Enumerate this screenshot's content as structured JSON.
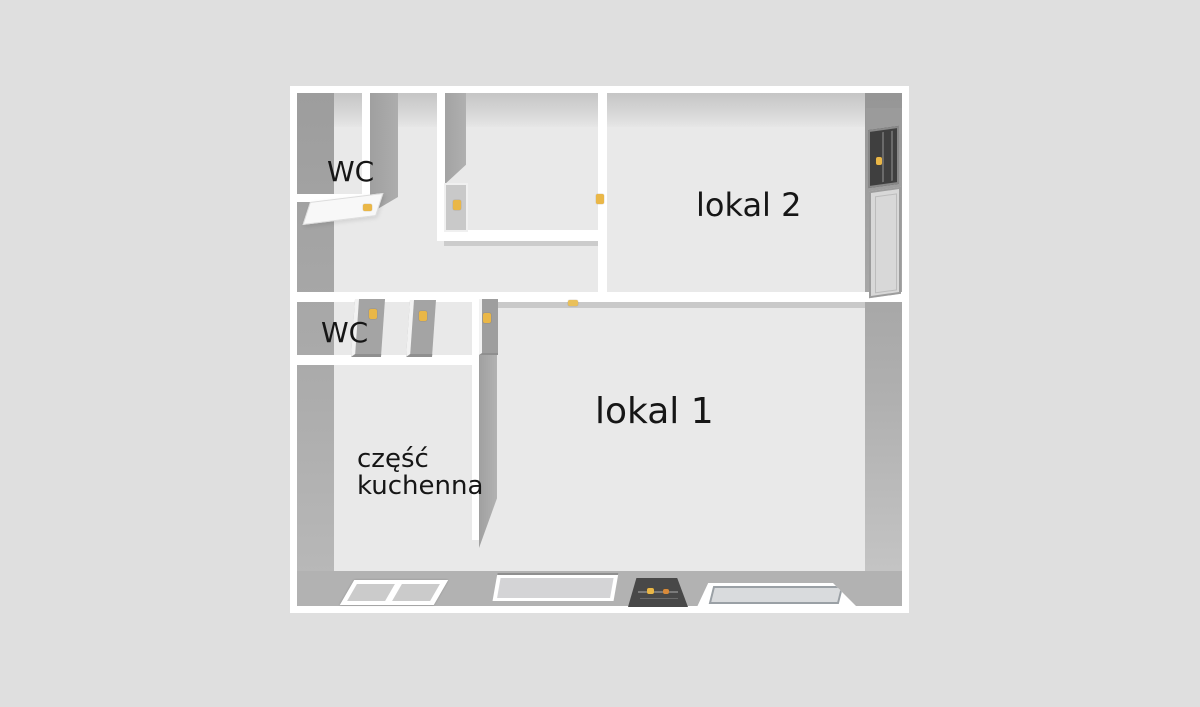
{
  "floorplan": {
    "rooms": [
      {
        "id": "wc-top",
        "label": "WC"
      },
      {
        "id": "lokal-2",
        "label": "lokal 2"
      },
      {
        "id": "wc-middle",
        "label": "WC"
      },
      {
        "id": "kitchen",
        "label": "część\nkuchenna"
      },
      {
        "id": "lokal-1",
        "label": "lokal 1"
      }
    ],
    "colors": {
      "page_background": "#dfdfdf",
      "floor": "#e9e9e9",
      "wall_top": "#ffffff",
      "wall_side": "#a6a6a6",
      "bottom_wall": "#b2b2b2",
      "door_handle_accent": "#eab747",
      "dark_fixture": "#3f3f3f",
      "window_pane": "#d2d2d4",
      "label_text": "#161616"
    },
    "fixtures": [
      {
        "id": "door-handle-wc-top"
      },
      {
        "id": "door-handle-hall"
      },
      {
        "id": "door-handle-middle-1"
      },
      {
        "id": "door-handle-middle-2"
      },
      {
        "id": "door-handle-kitchen"
      },
      {
        "id": "door-handle-lokal-2"
      },
      {
        "id": "ceiling-light-lokal-1"
      },
      {
        "id": "dark-window-lokal-2"
      },
      {
        "id": "entry-door-lokal-2"
      },
      {
        "id": "double-window-kitchen"
      },
      {
        "id": "window-lokal-1-left"
      },
      {
        "id": "heater-lokal-1"
      },
      {
        "id": "window-lokal-1-right"
      }
    ]
  }
}
